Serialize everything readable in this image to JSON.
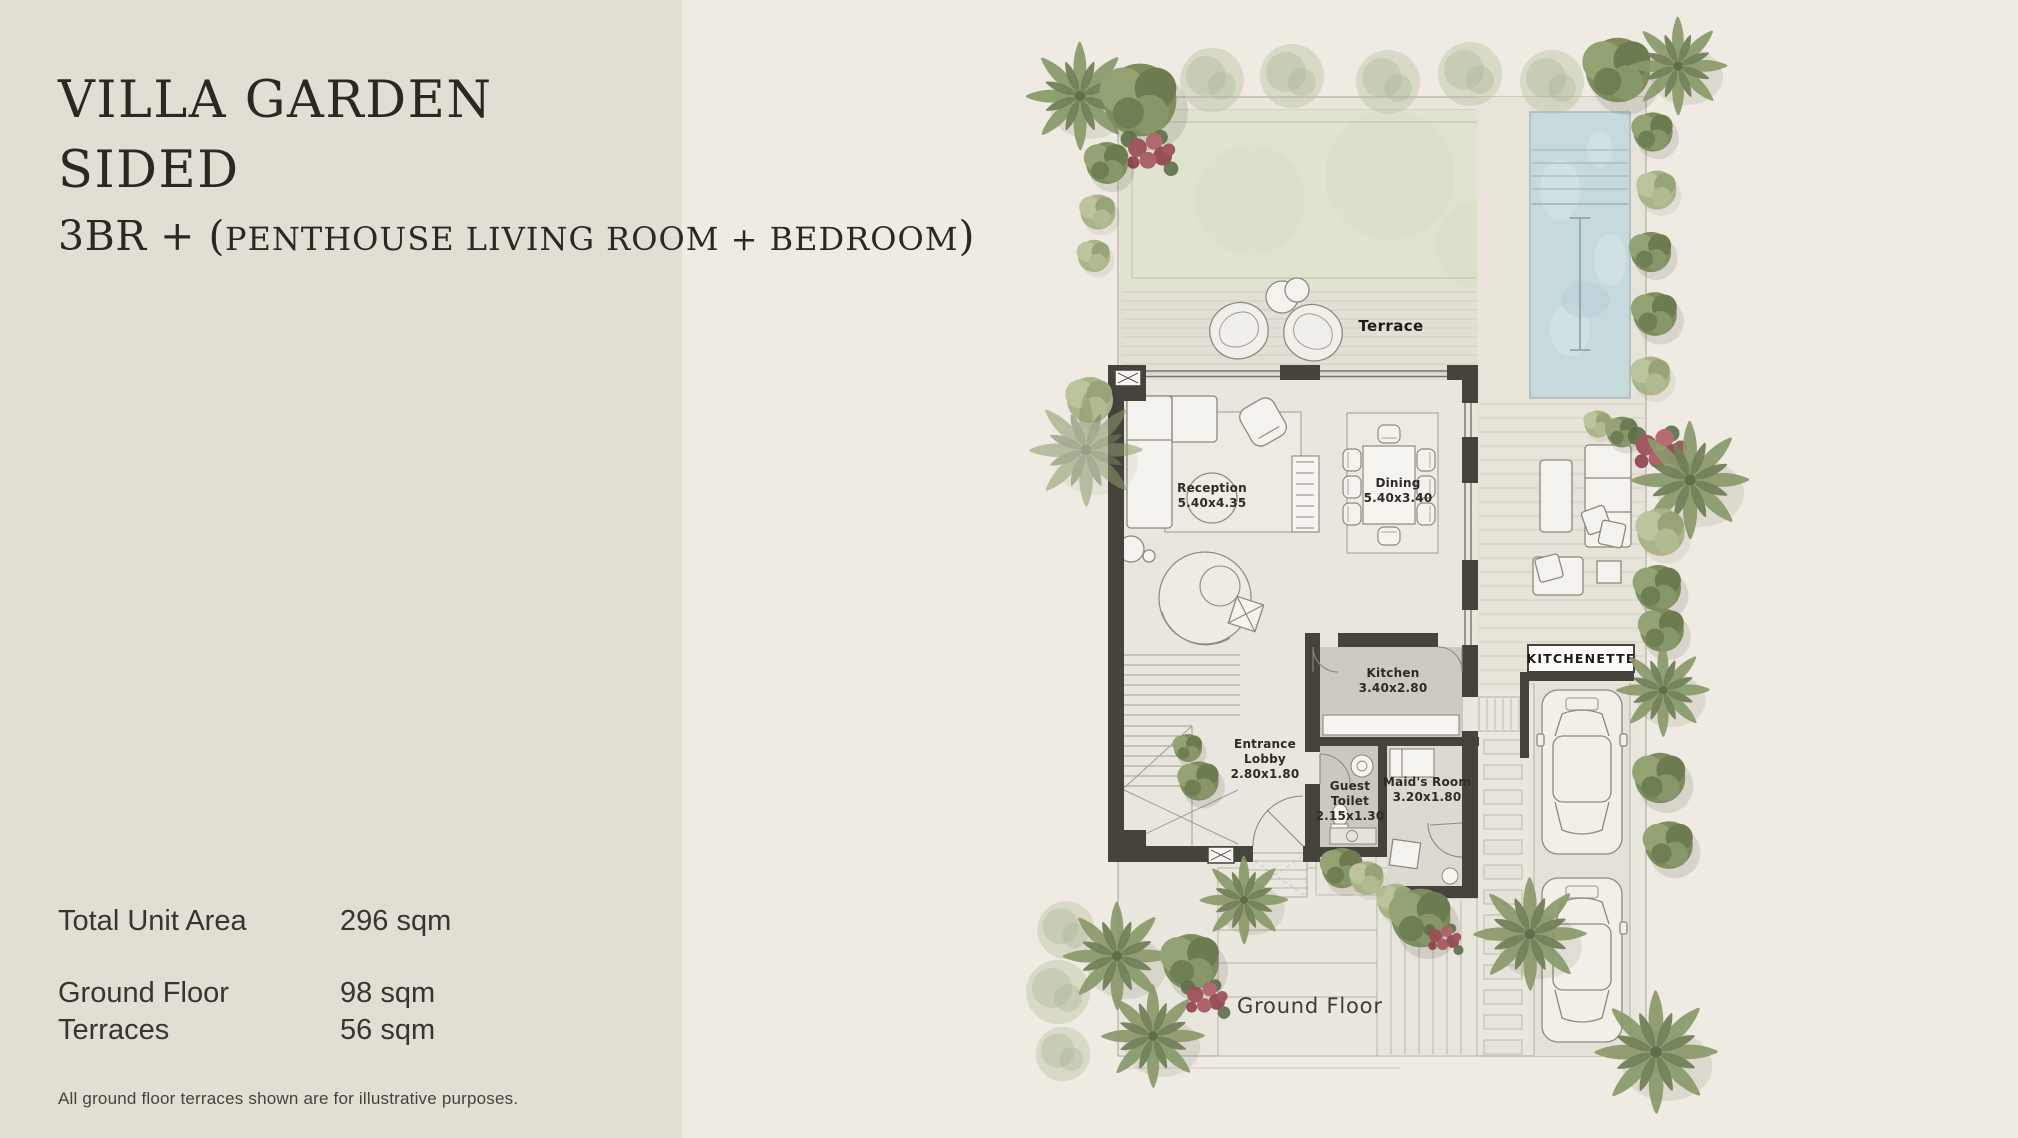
{
  "panel": {
    "title_line1": "VILLA GARDEN",
    "title_line2": "SIDED",
    "subtitle_prefix": "3BR + (",
    "subtitle_caps": "PENTHOUSE LIVING ROOM + BEDROOM",
    "subtitle_suffix": ")",
    "stats": [
      {
        "label": "Total Unit Area",
        "value": "296 sqm"
      },
      {
        "label": "Ground Floor",
        "value": "98 sqm"
      },
      {
        "label": "Terraces",
        "value": "56 sqm"
      }
    ],
    "footnote": "All ground floor terraces shown are for illustrative purposes."
  },
  "plan": {
    "labels": {
      "terrace": "Terrace",
      "ground_floor": "Ground Floor",
      "kitchenette": "KITCHENETTE"
    },
    "rooms": {
      "reception": {
        "name": "Reception",
        "dims": "5.40x4.35"
      },
      "dining": {
        "name": "Dining",
        "dims": "5.40x3.40"
      },
      "kitchen": {
        "name": "Kitchen",
        "dims": "3.40x2.80"
      },
      "entrance_lobby": {
        "line1": "Entrance",
        "line2": "Lobby",
        "dims": "2.80x1.80"
      },
      "guest_toilet": {
        "line1": "Guest",
        "line2": "Toilet",
        "dims": "2.15x1.30"
      },
      "maids_room": {
        "name": "Maid's Room",
        "dims": "3.20x1.80"
      }
    },
    "colors": {
      "left_panel_bg": "#e1ded3",
      "canvas_bg": "#efebe3",
      "lawn": "#dfe3d0",
      "pool_water": "#c6dade",
      "wall": "#46423c",
      "wet_room_floor": "#cdcac2",
      "greenery_dark": "#6c7c50",
      "greenery_mid": "#8a9a6b",
      "greenery_light": "#a9b488",
      "bougainvillea": "#a04e56",
      "heading_text": "#2b2823"
    }
  }
}
